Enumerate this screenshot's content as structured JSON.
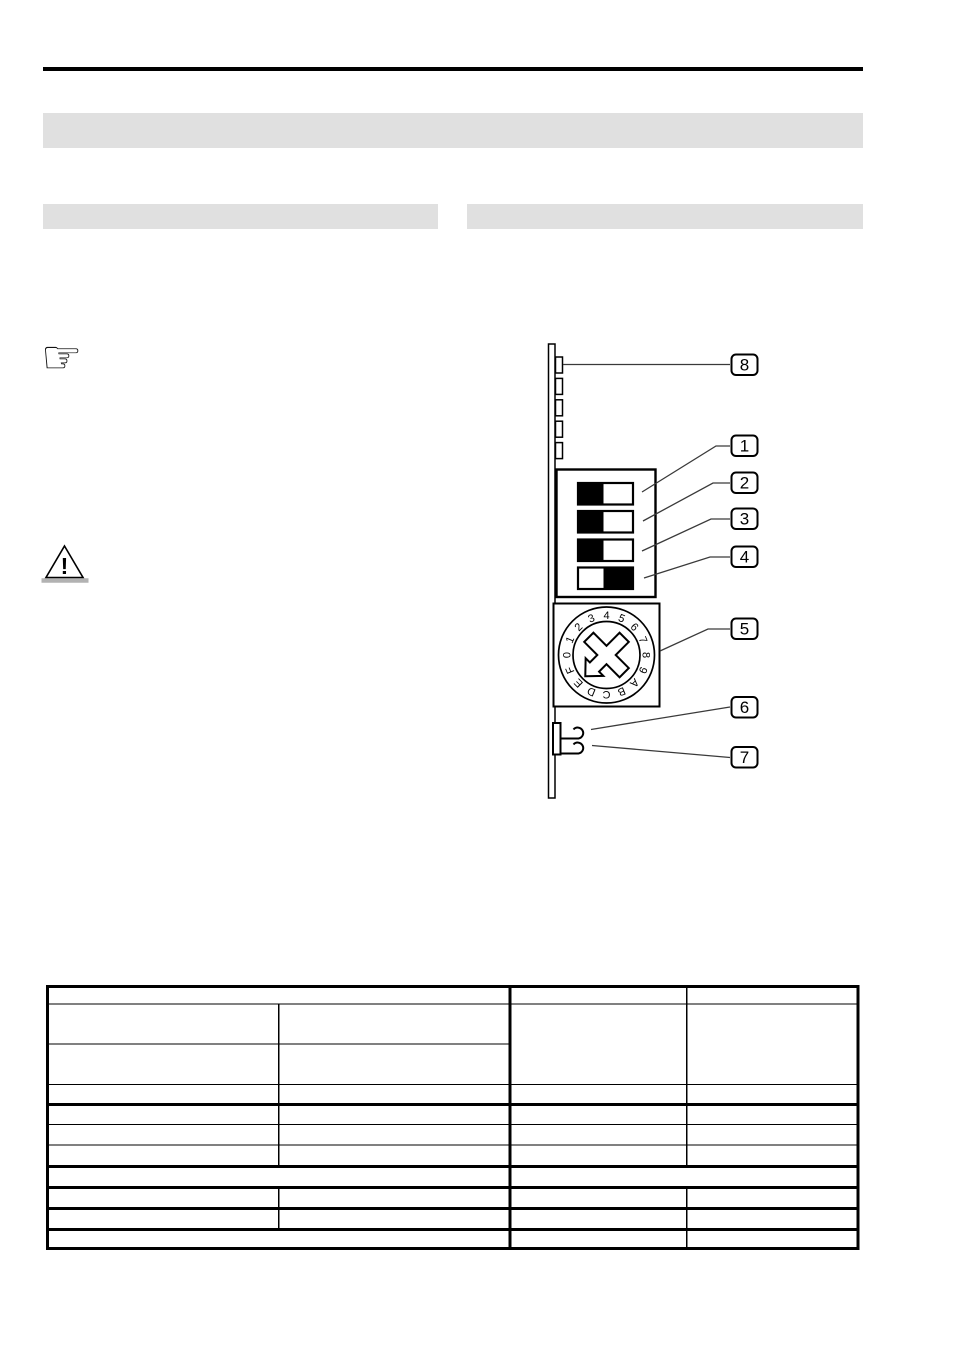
{
  "page": {
    "type": "technical-manual-page-no-text",
    "colors": {
      "section_bar_gray": "#e0e0e0",
      "ink_black": "#000000",
      "leader_line": "#3a3a3a",
      "warning_base_gray": "#b2b2b2"
    }
  },
  "icons": {
    "manicule": "☞",
    "warning_mark": "!"
  },
  "diagram": {
    "callout_labels": [
      "8",
      "1",
      "2",
      "3",
      "4",
      "5",
      "6",
      "7"
    ],
    "dip_switches": [
      {
        "label": "switch-1",
        "left_fill": "#000000",
        "right_fill": "#ffffff"
      },
      {
        "label": "switch-2",
        "left_fill": "#000000",
        "right_fill": "#ffffff"
      },
      {
        "label": "switch-3",
        "left_fill": "#000000",
        "right_fill": "#ffffff"
      },
      {
        "label": "switch-4",
        "left_fill": "#ffffff",
        "right_fill": "#000000"
      }
    ],
    "rotary_switch": {
      "positions": [
        "0",
        "1",
        "2",
        "3",
        "4",
        "5",
        "6",
        "7",
        "8",
        "9",
        "A",
        "B",
        "C",
        "D",
        "E",
        "F"
      ],
      "pointer_direction": "southwest"
    }
  },
  "table": {
    "columns": 4,
    "rows": 11,
    "all_cells_empty": true
  }
}
